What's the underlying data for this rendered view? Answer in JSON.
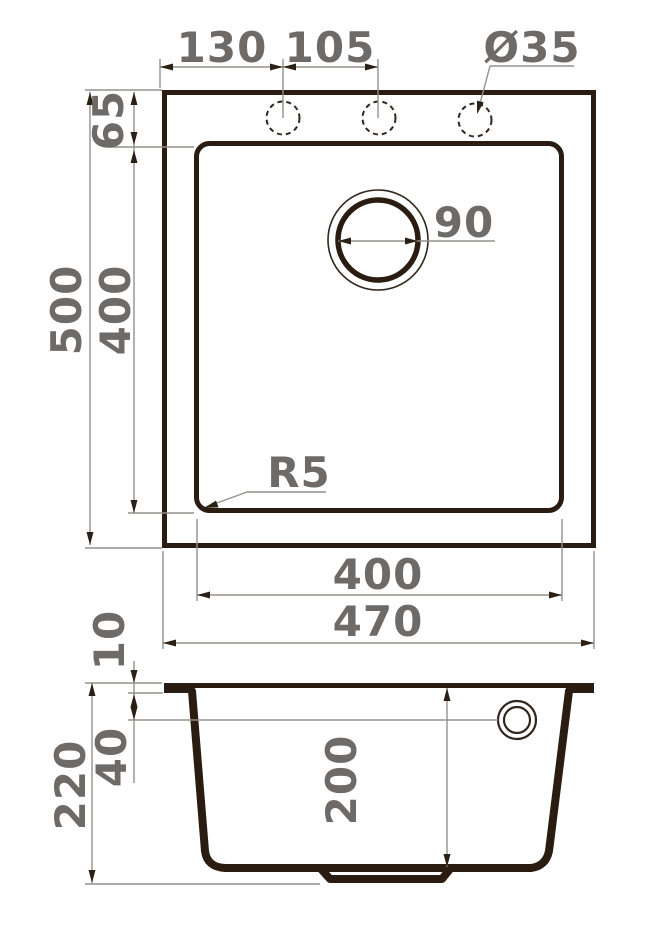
{
  "drawing": {
    "subject": "kitchen-sink-dimension-drawing",
    "colors": {
      "line_dark": "#2b1c11",
      "dim_text_gray": "#6d6a67",
      "thin_line_gray": "#95908b",
      "background": "#ffffff"
    },
    "top_view": {
      "dim_hole_offset_left": "130",
      "dim_hole_spacing": "105",
      "dim_faucet_hole_diameter": "Ø35",
      "dim_rim_to_bowl_top": "65",
      "dim_overall_height": "500",
      "dim_bowl_height": "400",
      "dim_drain_diameter": "90",
      "dim_corner_radius": "R5",
      "dim_bowl_width": "400",
      "dim_overall_width": "470"
    },
    "section_view": {
      "dim_rim_thickness": "10",
      "dim_overflow_offset": "40",
      "dim_overall_depth": "220",
      "dim_bowl_depth": "200"
    }
  }
}
